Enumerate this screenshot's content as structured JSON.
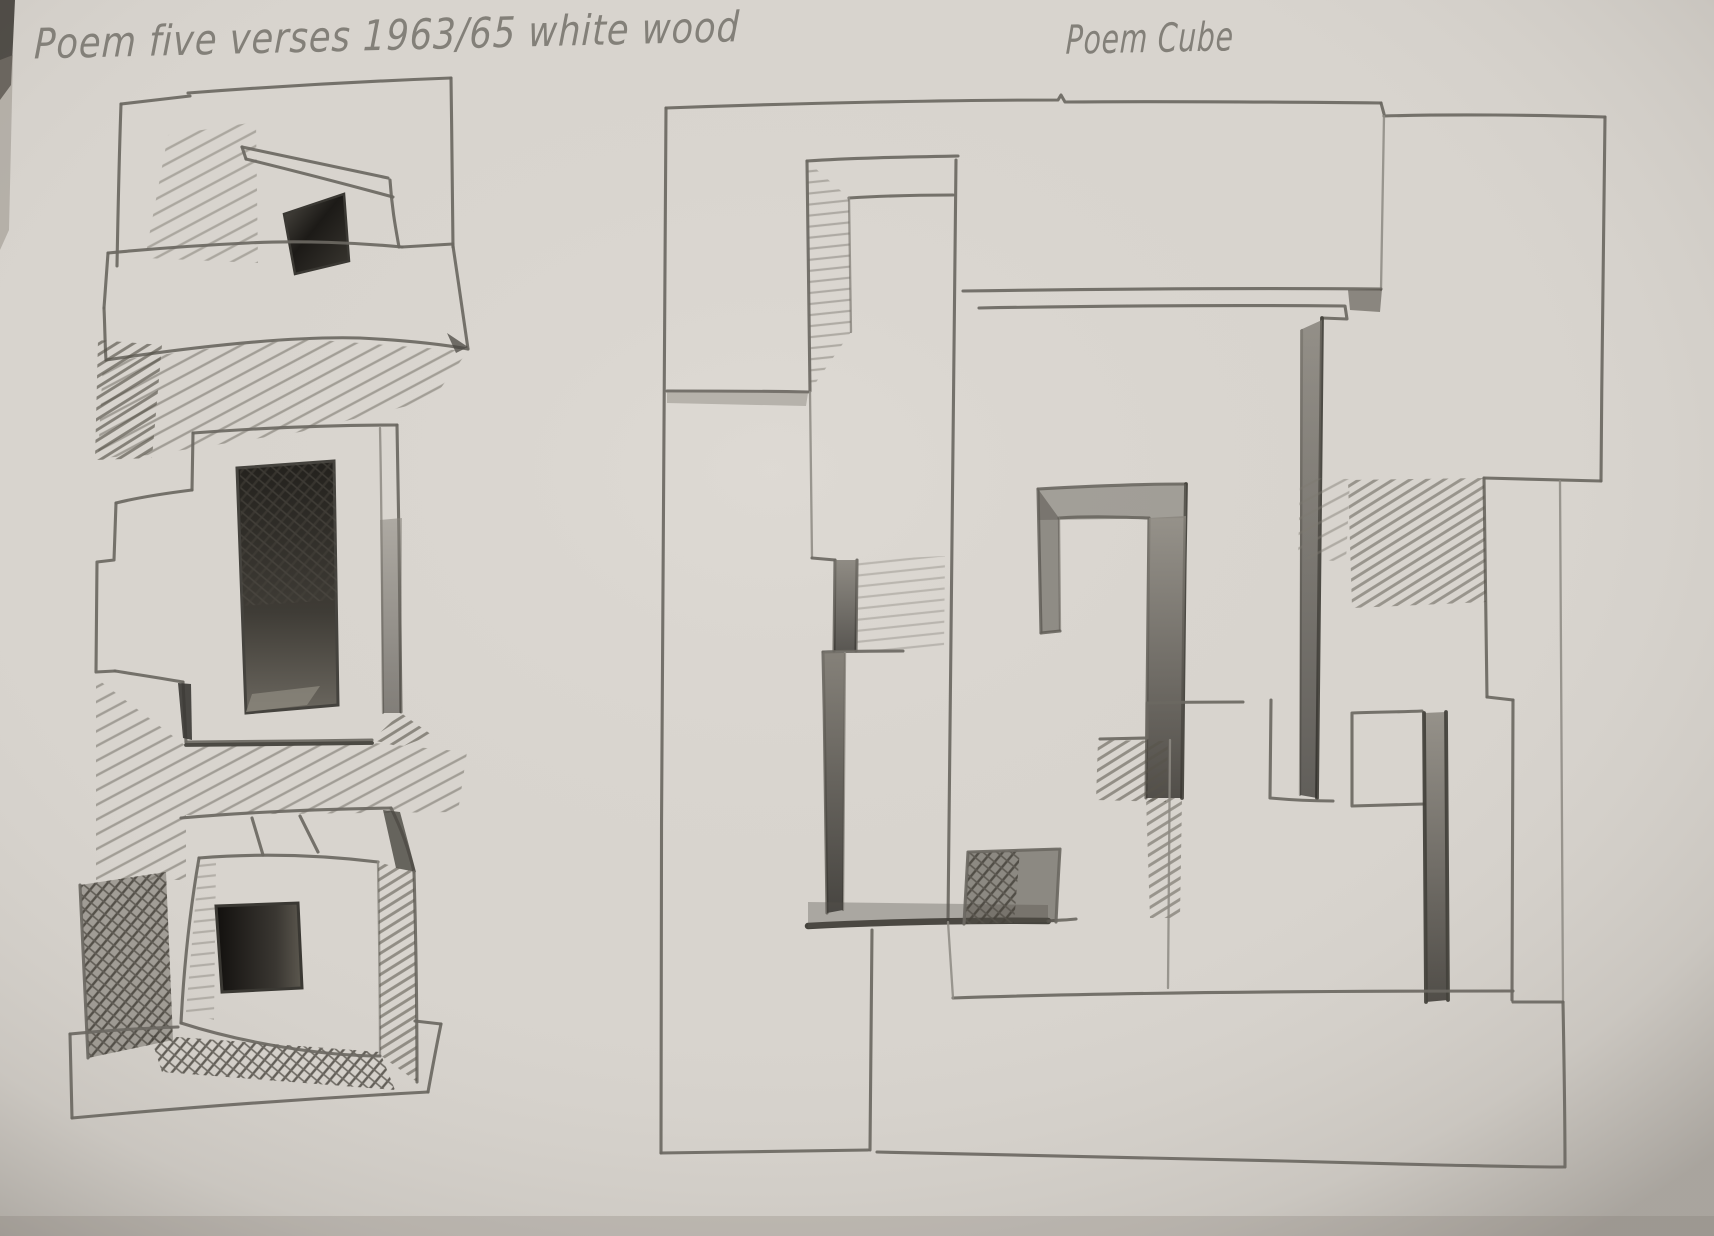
{
  "photo": {
    "kind": "pencil sketch on sketchbook paper"
  },
  "captions": {
    "left": "Poem five verses 1963/65 white wood",
    "right": "Poem Cube"
  },
  "sketches": {
    "left": {
      "id": "poem-five-verses",
      "caption_ref": "captions.left"
    },
    "right": {
      "id": "poem-cube",
      "caption_ref": "captions.right"
    }
  },
  "palette": {
    "paper": "#d8d4ce",
    "paper_shadow": "#aba69e",
    "pencil": "#6b6862",
    "pencil_dark": "#35332e",
    "handwriting": "#7f7c75",
    "opening_dark": "#1c1a17"
  }
}
